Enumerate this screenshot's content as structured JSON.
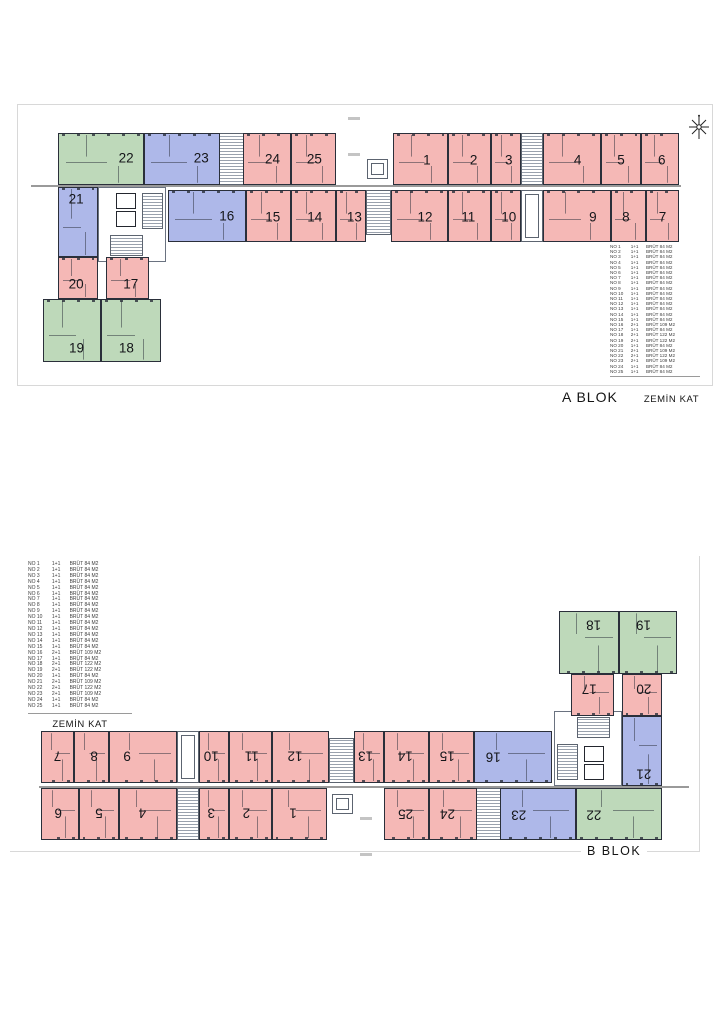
{
  "blocks": {
    "a": {
      "name": "A BLOK",
      "floor": "ZEMİN KAT"
    },
    "b": {
      "name": "B BLOK",
      "floor": "ZEMİN KAT"
    }
  },
  "icons": {
    "compass": "north-compass-rose"
  },
  "colors": {
    "unit_1plus1": "#f5b8b6",
    "unit_2plus1_109": "#aeb8e9",
    "unit_2plus1_122": "#bed9ba",
    "wall_outline": "#2a2f3a",
    "sheet_border": "#d8d8d8"
  },
  "legend": {
    "rows": [
      {
        "no": "NO 1",
        "type": "1+1",
        "area": "BRÜT 84 M2"
      },
      {
        "no": "NO 2",
        "type": "1+1",
        "area": "BRÜT 84 M2"
      },
      {
        "no": "NO 3",
        "type": "1+1",
        "area": "BRÜT 84 M2"
      },
      {
        "no": "NO 4",
        "type": "1+1",
        "area": "BRÜT 84 M2"
      },
      {
        "no": "NO 5",
        "type": "1+1",
        "area": "BRÜT 84 M2"
      },
      {
        "no": "NO 6",
        "type": "1+1",
        "area": "BRÜT 84 M2"
      },
      {
        "no": "NO 7",
        "type": "1+1",
        "area": "BRÜT 84 M2"
      },
      {
        "no": "NO 8",
        "type": "1+1",
        "area": "BRÜT 84 M2"
      },
      {
        "no": "NO 9",
        "type": "1+1",
        "area": "BRÜT 84 M2"
      },
      {
        "no": "NO 10",
        "type": "1+1",
        "area": "BRÜT 84 M2"
      },
      {
        "no": "NO 11",
        "type": "1+1",
        "area": "BRÜT 84 M2"
      },
      {
        "no": "NO 12",
        "type": "1+1",
        "area": "BRÜT 84 M2"
      },
      {
        "no": "NO 13",
        "type": "1+1",
        "area": "BRÜT 84 M2"
      },
      {
        "no": "NO 14",
        "type": "1+1",
        "area": "BRÜT 84 M2"
      },
      {
        "no": "NO 15",
        "type": "1+1",
        "area": "BRÜT 84 M2"
      },
      {
        "no": "NO 16",
        "type": "2+1",
        "area": "BRÜT 109 M2"
      },
      {
        "no": "NO 17",
        "type": "1+1",
        "area": "BRÜT 84 M2"
      },
      {
        "no": "NO 18",
        "type": "2+1",
        "area": "BRÜT 122 M2"
      },
      {
        "no": "NO 19",
        "type": "2+1",
        "area": "BRÜT 122 M2"
      },
      {
        "no": "NO 20",
        "type": "1+1",
        "area": "BRÜT 84 M2"
      },
      {
        "no": "NO 21",
        "type": "2+1",
        "area": "BRÜT 109 M2"
      },
      {
        "no": "NO 22",
        "type": "2+1",
        "area": "BRÜT 122 M2"
      },
      {
        "no": "NO 23",
        "type": "2+1",
        "area": "BRÜT 109 M2"
      },
      {
        "no": "NO 24",
        "type": "1+1",
        "area": "BRÜT 84 M2"
      },
      {
        "no": "NO 25",
        "type": "1+1",
        "area": "BRÜT 84 M2"
      }
    ]
  },
  "plan": {
    "units": [
      {
        "n": "22",
        "color": "green",
        "x": 40,
        "y": 28,
        "w": 86,
        "h": 52,
        "lx": 80,
        "ly": 47
      },
      {
        "n": "23",
        "color": "blue",
        "x": 126,
        "y": 28,
        "w": 76,
        "h": 52,
        "lx": 76,
        "ly": 47
      },
      {
        "n": "24",
        "color": "pink",
        "x": 225,
        "y": 28,
        "w": 48,
        "h": 52,
        "lx": 62,
        "ly": 50
      },
      {
        "n": "25",
        "color": "pink",
        "x": 273,
        "y": 28,
        "w": 45,
        "h": 52,
        "lx": 52,
        "ly": 50
      },
      {
        "n": "1",
        "color": "pink",
        "x": 375,
        "y": 28,
        "w": 55,
        "h": 52,
        "lx": 62,
        "ly": 52
      },
      {
        "n": "2",
        "color": "pink",
        "x": 430,
        "y": 28,
        "w": 43,
        "h": 52,
        "lx": 60,
        "ly": 52
      },
      {
        "n": "3",
        "color": "pink",
        "x": 473,
        "y": 28,
        "w": 30,
        "h": 52,
        "lx": 60,
        "ly": 52
      },
      {
        "n": "4",
        "color": "pink",
        "x": 525,
        "y": 28,
        "w": 58,
        "h": 52,
        "lx": 60,
        "ly": 52
      },
      {
        "n": "5",
        "color": "pink",
        "x": 583,
        "y": 28,
        "w": 40,
        "h": 52,
        "lx": 50,
        "ly": 52
      },
      {
        "n": "6",
        "color": "pink",
        "x": 623,
        "y": 28,
        "w": 38,
        "h": 52,
        "lx": 55,
        "ly": 52
      },
      {
        "n": "16",
        "color": "blue",
        "x": 150,
        "y": 85,
        "w": 78,
        "h": 52,
        "lx": 76,
        "ly": 50
      },
      {
        "n": "15",
        "color": "pink",
        "x": 228,
        "y": 85,
        "w": 45,
        "h": 52,
        "lx": 60,
        "ly": 52
      },
      {
        "n": "14",
        "color": "pink",
        "x": 273,
        "y": 85,
        "w": 45,
        "h": 52,
        "lx": 53,
        "ly": 52
      },
      {
        "n": "13",
        "color": "pink",
        "x": 318,
        "y": 85,
        "w": 30,
        "h": 52,
        "lx": 62,
        "ly": 52
      },
      {
        "n": "12",
        "color": "pink",
        "x": 373,
        "y": 85,
        "w": 57,
        "h": 52,
        "lx": 60,
        "ly": 52
      },
      {
        "n": "11",
        "color": "pink",
        "x": 430,
        "y": 85,
        "w": 43,
        "h": 52,
        "lx": 47,
        "ly": 52
      },
      {
        "n": "10",
        "color": "pink",
        "x": 473,
        "y": 85,
        "w": 30,
        "h": 52,
        "lx": 60,
        "ly": 52
      },
      {
        "n": "9",
        "color": "pink",
        "x": 525,
        "y": 85,
        "w": 68,
        "h": 52,
        "lx": 74,
        "ly": 52
      },
      {
        "n": "8",
        "color": "pink",
        "x": 593,
        "y": 85,
        "w": 35,
        "h": 52,
        "lx": 42,
        "ly": 52
      },
      {
        "n": "7",
        "color": "pink",
        "x": 628,
        "y": 85,
        "w": 33,
        "h": 52,
        "lx": 50,
        "ly": 52
      },
      {
        "n": "21",
        "color": "blue",
        "x": 40,
        "y": 82,
        "w": 40,
        "h": 70,
        "lx": 45,
        "ly": 16
      },
      {
        "n": "20",
        "color": "pink",
        "x": 40,
        "y": 152,
        "w": 40,
        "h": 42,
        "lx": 45,
        "ly": 64
      },
      {
        "n": "17",
        "color": "pink",
        "x": 88,
        "y": 152,
        "w": 43,
        "h": 42,
        "lx": 58,
        "ly": 64
      },
      {
        "n": "19",
        "color": "green",
        "x": 25,
        "y": 194,
        "w": 58,
        "h": 63,
        "lx": 58,
        "ly": 78
      },
      {
        "n": "18",
        "color": "green",
        "x": 83,
        "y": 194,
        "w": 60,
        "h": 63,
        "lx": 42,
        "ly": 78
      }
    ],
    "features": [
      {
        "t": "corridor",
        "x": 13,
        "y": 80,
        "w": 650,
        "h": 2
      },
      {
        "t": "stair",
        "x": 201,
        "y": 28,
        "w": 25,
        "h": 52
      },
      {
        "t": "stair",
        "x": 503,
        "y": 28,
        "w": 22,
        "h": 52
      },
      {
        "t": "stair",
        "x": 348,
        "y": 85,
        "w": 25,
        "h": 45
      },
      {
        "t": "core",
        "x": 80,
        "y": 82,
        "w": 68,
        "h": 75
      },
      {
        "t": "shaft",
        "x": 98,
        "y": 88,
        "w": 20,
        "h": 16
      },
      {
        "t": "shaft",
        "x": 98,
        "y": 106,
        "w": 20,
        "h": 16
      },
      {
        "t": "stair",
        "x": 124,
        "y": 88,
        "w": 21,
        "h": 36
      },
      {
        "t": "stair",
        "x": 92,
        "y": 130,
        "w": 33,
        "h": 21
      },
      {
        "t": "elev",
        "x": 349,
        "y": 54,
        "w": 21,
        "h": 20
      },
      {
        "t": "elev",
        "x": 503,
        "y": 85,
        "w": 22,
        "h": 52
      },
      {
        "t": "mark",
        "x": 330,
        "y": 12,
        "w": 12,
        "h": 3
      },
      {
        "t": "mark",
        "x": 330,
        "y": 48,
        "w": 12,
        "h": 3
      },
      {
        "t": "mark",
        "x": 330,
        "y": 92,
        "w": 12,
        "h": 3
      }
    ]
  }
}
